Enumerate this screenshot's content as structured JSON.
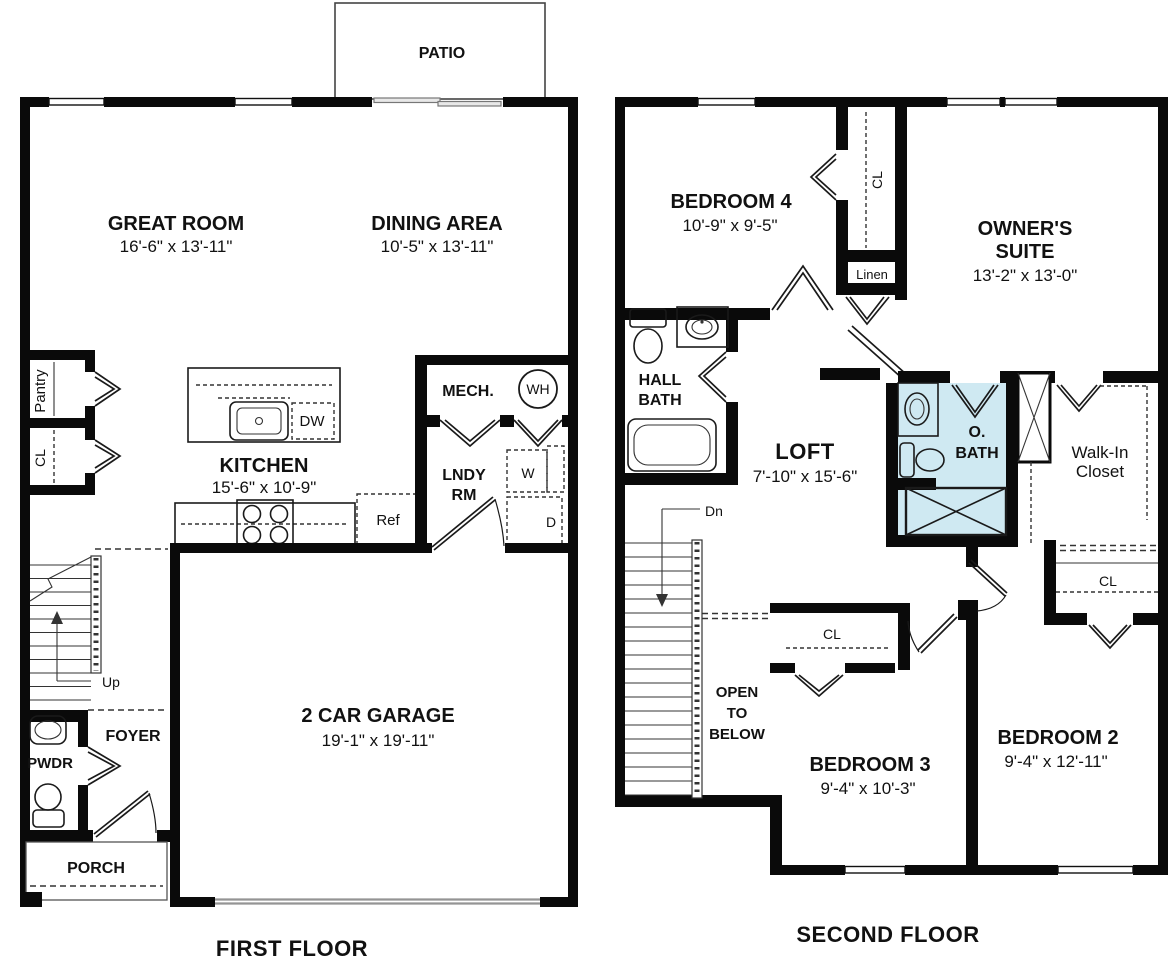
{
  "colors": {
    "wall": "#0a0a0a",
    "owner_bath_fill": "#cfe9f2",
    "garage_door_gray": "#949494"
  },
  "first_floor": {
    "title": "FIRST FLOOR",
    "patio": "PATIO",
    "great_room": {
      "name": "GREAT ROOM",
      "dims": "16'-6\" x 13'-11\""
    },
    "dining": {
      "name": "DINING AREA",
      "dims": "10'-5\" x 13'-11\""
    },
    "kitchen": {
      "name": "KITCHEN",
      "dims": "15'-6\" x 10'-9\""
    },
    "garage": {
      "name": "2 CAR GARAGE",
      "dims": "19'-1\" x 19'-11\""
    },
    "pantry": "Pantry",
    "closet": "CL",
    "mech": "MECH.",
    "water_heater": "WH",
    "laundry_line1": "LNDY",
    "laundry_line2": "RM",
    "washer": "W",
    "dryer": "D",
    "fridge": "Ref",
    "dishwasher": "DW",
    "up": "Up",
    "foyer": "FOYER",
    "powder": "PWDR",
    "porch": "PORCH"
  },
  "second_floor": {
    "title": "SECOND FLOOR",
    "bedroom4": {
      "name": "BEDROOM 4",
      "dims": "10'-9\" x 9'-5\""
    },
    "owners_suite": {
      "line1": "OWNER'S",
      "line2": "SUITE",
      "dims": "13'-2\" x 13'-0\""
    },
    "loft": {
      "name": "LOFT",
      "dims": "7'-10\" x 15'-6\""
    },
    "bedroom3": {
      "name": "BEDROOM 3",
      "dims": "9'-4\" x 10'-3\""
    },
    "bedroom2": {
      "name": "BEDROOM 2",
      "dims": "9'-4\" x 12'-11\""
    },
    "hall_bath_line1": "HALL",
    "hall_bath_line2": "BATH",
    "owners_bath_line1": "O.",
    "owners_bath_line2": "BATH",
    "walk_in_line1": "Walk-In",
    "walk_in_line2": "Closet",
    "linen": "Linen",
    "closet_b4": "CL",
    "closet_b3": "CL",
    "closet_b2": "CL",
    "down": "Dn",
    "open_below_line1": "OPEN",
    "open_below_line2": "TO",
    "open_below_line3": "BELOW"
  }
}
